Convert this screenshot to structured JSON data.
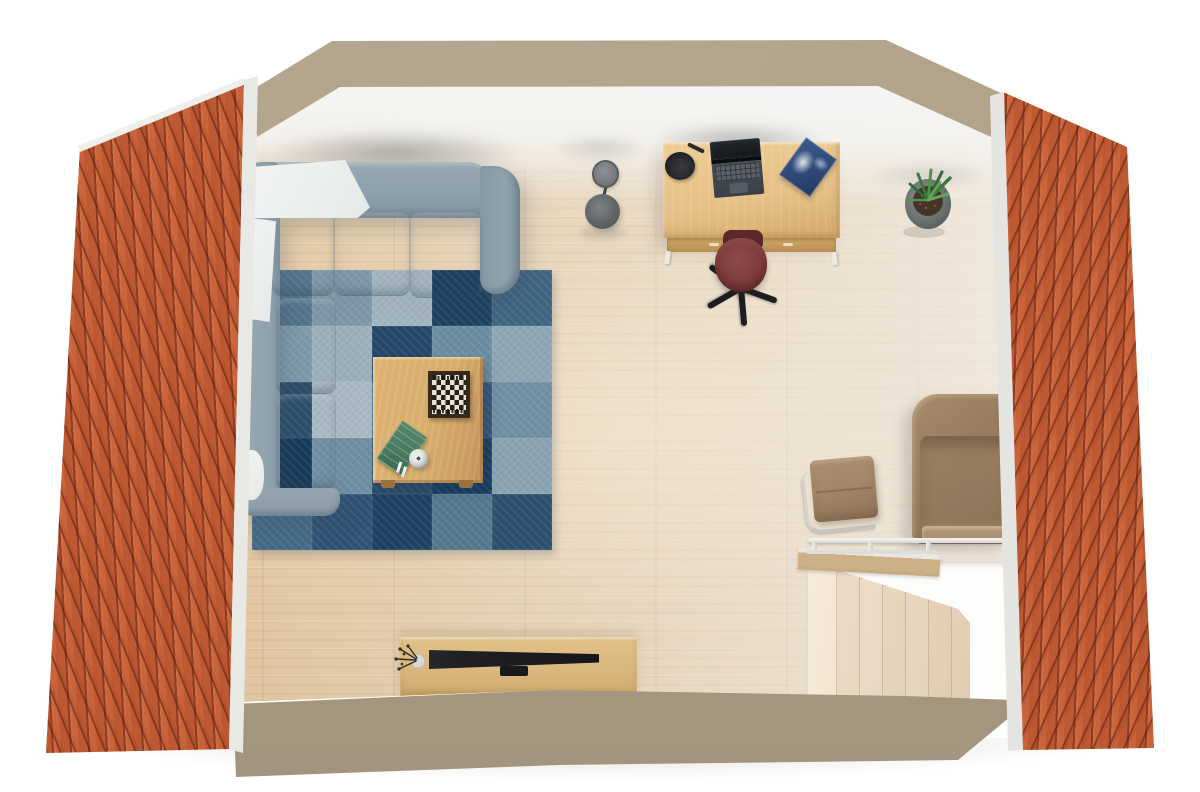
{
  "meta": {
    "description": "Top-down 3D rendering of an attic living room floor plan, flanked by two orange tiled roof slopes",
    "view": "top-down 3d render",
    "canvas": {
      "width": 1200,
      "height": 792
    }
  },
  "colors": {
    "roof_tile": "#c05d36",
    "roof_edge": "#f1f1ee",
    "wall_band_top": "#b5a78e",
    "wall_band_bottom": "#a2947d",
    "floor": "#dfc197",
    "opening_white": "#fdfdfc",
    "stair_light": "#f6ead9",
    "stair_dark": "#e8d2b6",
    "sofa_back": "#8ea0ab",
    "sofa_seat": "#7d909c",
    "sofa_arm": "#97a7b1",
    "throw_white": "#f3f5f4",
    "table_wood": "#d8ad6b",
    "table_wood_dark": "#c2935a",
    "chess_frame": "#38291b",
    "chess_light": "#e9e4d8",
    "chess_dark": "#2a211a",
    "book_green": "#47795f",
    "bowl": "#c9cdcc",
    "desk_wood": "#e7c288",
    "desk_wood_dark": "#d3a96c",
    "laptop_screen": "#14161a",
    "laptop_body": "#3c4046",
    "desk_lamp": "#222226",
    "book_blue": "#2e4877",
    "chair_red": "#7c3a3c",
    "chair_red_dark": "#5c282a",
    "chair_base_black": "#1d1d1f",
    "floor_lamp_top": "#76797b",
    "floor_lamp_base": "#5f6467",
    "plant_pot": "#6f7875",
    "plant_soil": "#463428",
    "plant_leaf": "#3e7a3b",
    "armchair": "#967b5f",
    "armchair_back": "#876e54",
    "armchair_light": "#ac9175",
    "side_chair_pad": "#a4876a",
    "chrome": "#d4d4d0",
    "railing": "#e9e8e4",
    "ledge_wood": "#cdb085",
    "tv_console": "#d8b67c",
    "tv_black": "#1f2125",
    "vase": "#d9d9d5",
    "twig": "#2c2c20"
  },
  "rug": {
    "cols": 5,
    "rows": 5,
    "patches": [
      [
        "#53748c",
        "#7e98a9",
        "#a3b5bf",
        "#1e4161",
        "#3f6580"
      ],
      [
        "#7f9aac",
        "#9db0bb",
        "#23466a",
        "#6c8ca1",
        "#8fa6b5"
      ],
      [
        "#2c4f6d",
        "#a9bac4",
        "#54778f",
        "#34587a",
        "#6f8fa3"
      ],
      [
        "#16395a",
        "#6f8fa3",
        "#2a4d6b",
        "#173f63",
        "#8aa3b2"
      ],
      [
        "#446a87",
        "#2f5275",
        "#1d4164",
        "#55788f",
        "#2c506e"
      ]
    ]
  },
  "stairs": {
    "steps": 6
  },
  "furniture": [
    "corner-sofa",
    "white-throw-blanket",
    "patchwork-rug",
    "coffee-table",
    "chessboard",
    "green-book",
    "bowl",
    "floor-lamp",
    "desk",
    "desk-lamp",
    "laptop",
    "blue-magazine",
    "office-chair",
    "potted-plant",
    "armchair",
    "cantilever-chair",
    "railing",
    "staircase",
    "tv-console",
    "television",
    "vase-with-twigs"
  ]
}
